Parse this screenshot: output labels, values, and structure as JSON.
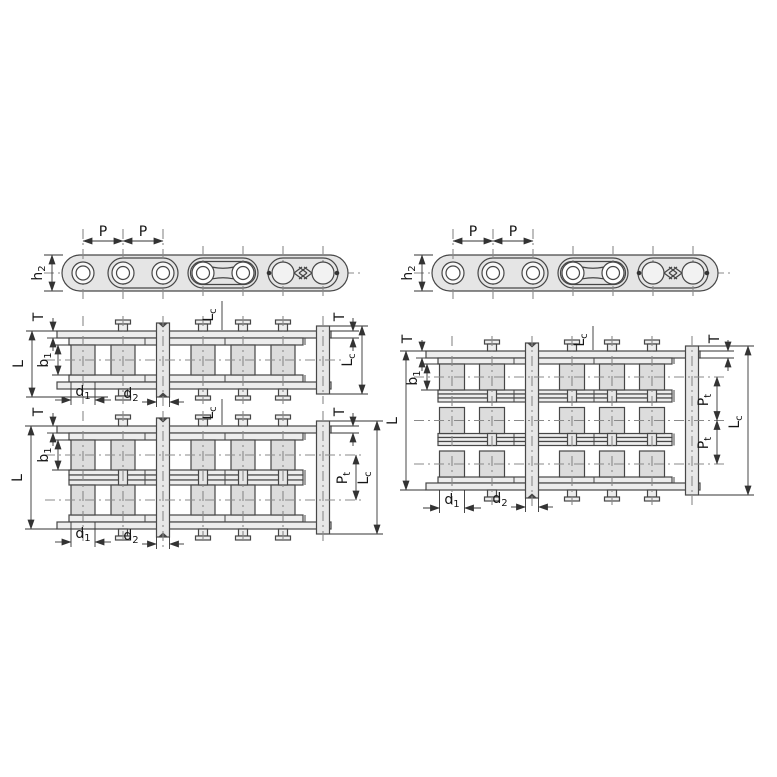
{
  "canvas": {
    "width": 777,
    "height": 777,
    "background": "#ffffff"
  },
  "style": {
    "outline": "#474747",
    "dim_line": "#333333",
    "center_line": "#8a8a8a",
    "text": "#161616",
    "body_fill": "#e5e5e5",
    "plate_fill": "#ededed",
    "roller_fill": "#dcdcdc",
    "pin_fill": "#e7e7e7",
    "circle_fill": "#f8f8f8",
    "arrow_fill": "#333333"
  },
  "labels": {
    "P": {
      "main": "P",
      "sub": ""
    },
    "h2": {
      "main": "h",
      "sub": "2"
    },
    "T": {
      "main": "T",
      "sub": ""
    },
    "L": {
      "main": "L",
      "sub": ""
    },
    "b1": {
      "main": "b",
      "sub": "1"
    },
    "d1": {
      "main": "d",
      "sub": "1"
    },
    "d2": {
      "main": "d",
      "sub": "2"
    },
    "Lc": {
      "main": "L",
      "sub": "c"
    },
    "Pt": {
      "main": "P",
      "sub": "t"
    }
  },
  "figures": [
    {
      "id": "side-view-left",
      "type": "chain-side-elevation",
      "dims": [
        "P",
        "P",
        "h2"
      ]
    },
    {
      "id": "side-view-right",
      "type": "chain-side-elevation",
      "dims": [
        "P",
        "P",
        "h2"
      ]
    },
    {
      "id": "plan-view-simplex",
      "type": "chain-plan-view",
      "strands": 1,
      "dims": [
        "T",
        "L",
        "b1",
        "d1",
        "d2",
        "Lc",
        "Lc",
        "T"
      ]
    },
    {
      "id": "plan-view-duplex",
      "type": "chain-plan-view",
      "strands": 2,
      "dims": [
        "T",
        "L",
        "b1",
        "d1",
        "d2",
        "Lc",
        "Pt",
        "Lc",
        "T"
      ]
    },
    {
      "id": "plan-view-triplex",
      "type": "chain-plan-view",
      "strands": 3,
      "dims": [
        "T",
        "L",
        "b1",
        "d1",
        "d2",
        "Lc",
        "Pt",
        "Pt",
        "Lc",
        "T"
      ]
    }
  ]
}
